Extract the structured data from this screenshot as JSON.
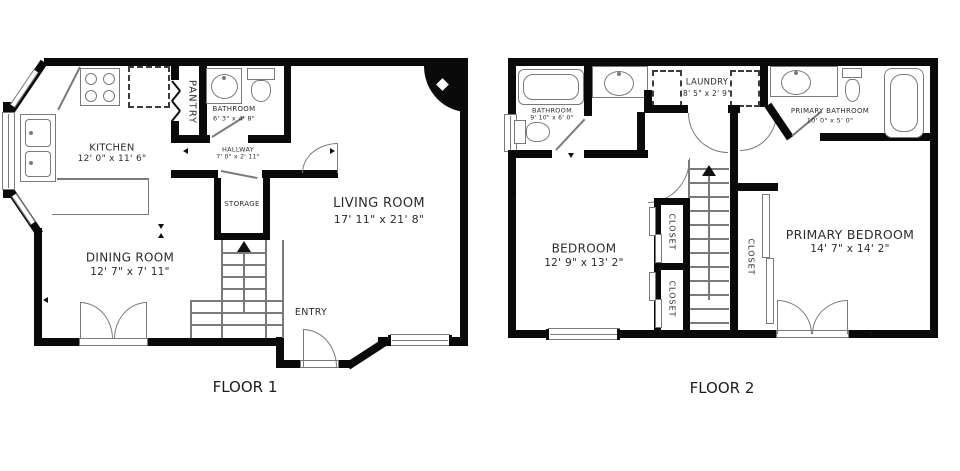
{
  "colors": {
    "wall": "#0a0a0a",
    "line": "#7a7a7a",
    "text": "#2c2c2c"
  },
  "floor1": {
    "title": "FLOOR 1",
    "rooms": {
      "kitchen": {
        "name": "KITCHEN",
        "dims": "12' 0\" x 11' 6\""
      },
      "pantry": {
        "name": "PANTRY"
      },
      "bathroom": {
        "name": "BATHROOM",
        "dims": "6' 3\" x 4' 8\""
      },
      "hallway": {
        "name": "HALLWAY",
        "dims": "7' 0\" x 2' 11\""
      },
      "storage": {
        "name": "STORAGE"
      },
      "living_room": {
        "name": "LIVING ROOM",
        "dims": "17' 11\" x 21' 8\""
      },
      "dining_room": {
        "name": "DINING ROOM",
        "dims": "12' 7\" x 7' 11\""
      },
      "entry": {
        "name": "ENTRY"
      }
    }
  },
  "floor2": {
    "title": "FLOOR 2",
    "rooms": {
      "bathroom": {
        "name": "BATHROOM",
        "dims": "9' 10\" x 6' 0\""
      },
      "laundry": {
        "name": "LAUNDRY",
        "dims": "8' 5\" x 2' 9\""
      },
      "primary_bathroom": {
        "name": "PRIMARY BATHROOM",
        "dims": "10' 0\" x 5' 0\""
      },
      "bedroom": {
        "name": "BEDROOM",
        "dims": "12' 9\" x 13' 2\""
      },
      "closet_a": {
        "name": "CLOSET"
      },
      "closet_b": {
        "name": "CLOSET"
      },
      "primary_closet": {
        "name": "CLOSET"
      },
      "primary_bedroom": {
        "name": "PRIMARY BEDROOM",
        "dims": "14' 7\" x 14' 2\""
      }
    }
  }
}
